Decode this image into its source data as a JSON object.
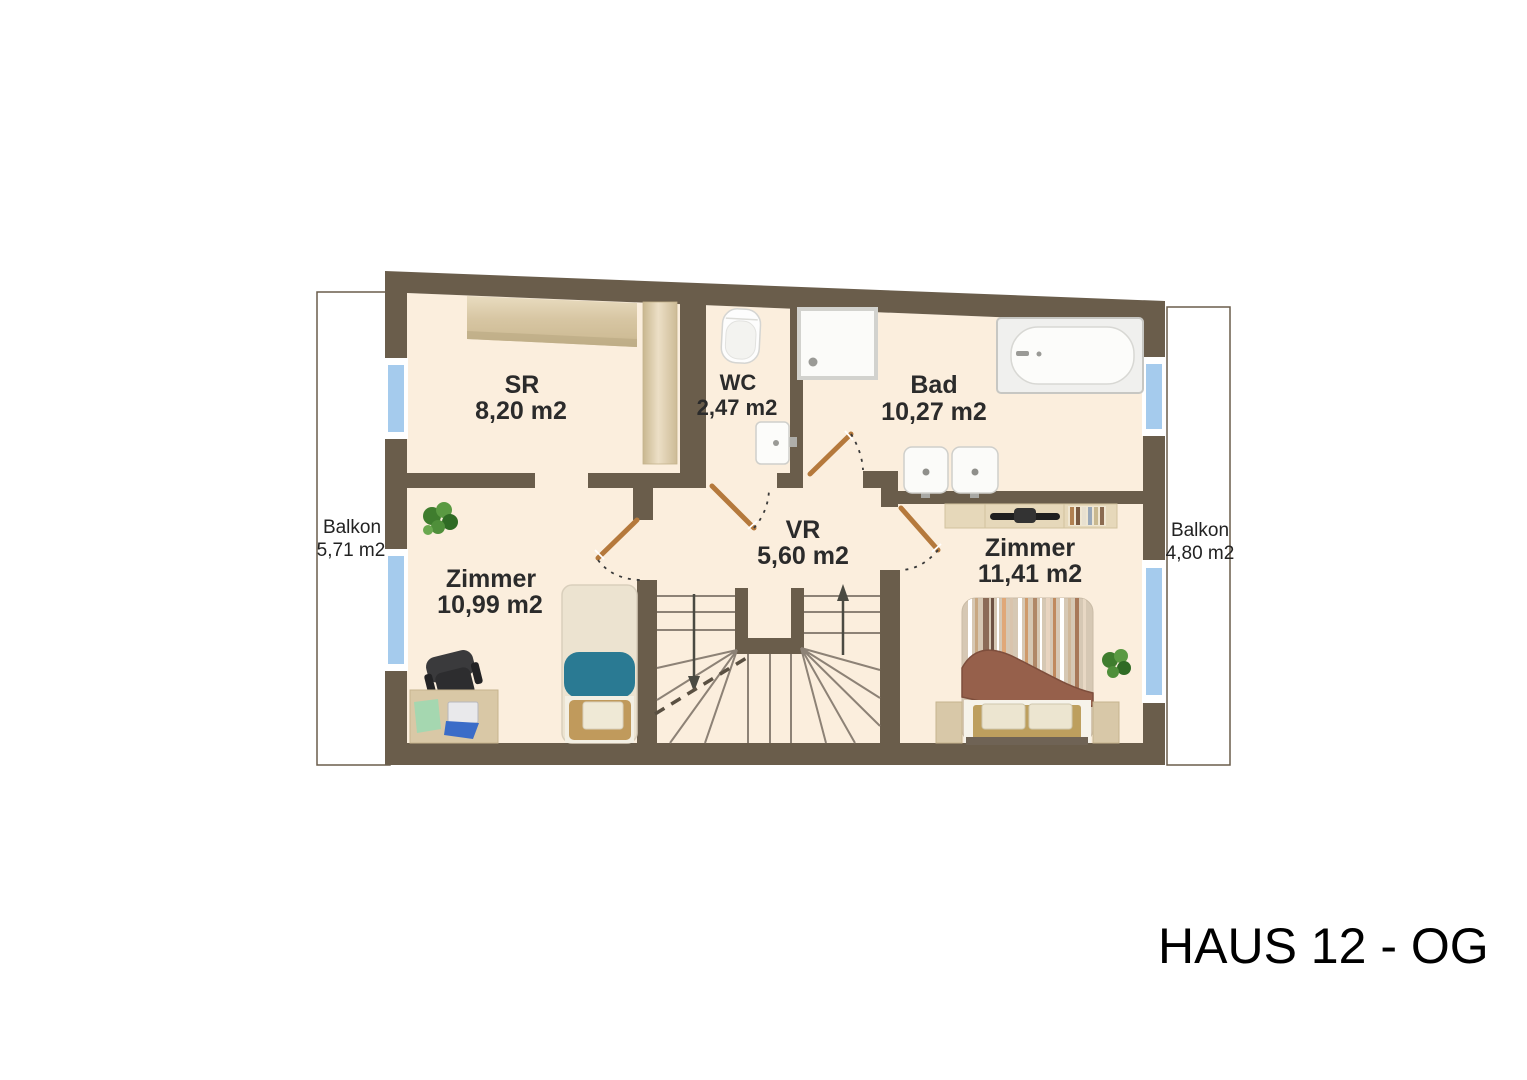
{
  "title": "HAUS 12 - OG",
  "rooms": [
    {
      "id": "sr",
      "name": "SR",
      "area": "8,20 m2"
    },
    {
      "id": "wc",
      "name": "WC",
      "area": "2,47 m2"
    },
    {
      "id": "bad",
      "name": "Bad",
      "area": "10,27 m2"
    },
    {
      "id": "vr",
      "name": "VR",
      "area": "5,60 m2"
    },
    {
      "id": "zimmer1",
      "name": "Zimmer",
      "area": "10,99 m2"
    },
    {
      "id": "zimmer2",
      "name": "Zimmer",
      "area": "11,41 m2"
    }
  ],
  "balconies": [
    {
      "id": "balkon-left",
      "name": "Balkon",
      "area": "5,71 m2"
    },
    {
      "id": "balkon-right",
      "name": "Balkon",
      "area": "4,80 m2"
    }
  ],
  "colors": {
    "wall": "#6a5d4b",
    "floor": "#fbeedd",
    "window_glass": "#a5cbed",
    "window_frame": "#ffffff",
    "door_leaf": "#b5793c",
    "wood_light": "#ddcfae",
    "teal_blanket": "#2a7a93",
    "brown_blanket": "#96604b",
    "stair_tread": "#8d8276",
    "background": "#ffffff"
  }
}
